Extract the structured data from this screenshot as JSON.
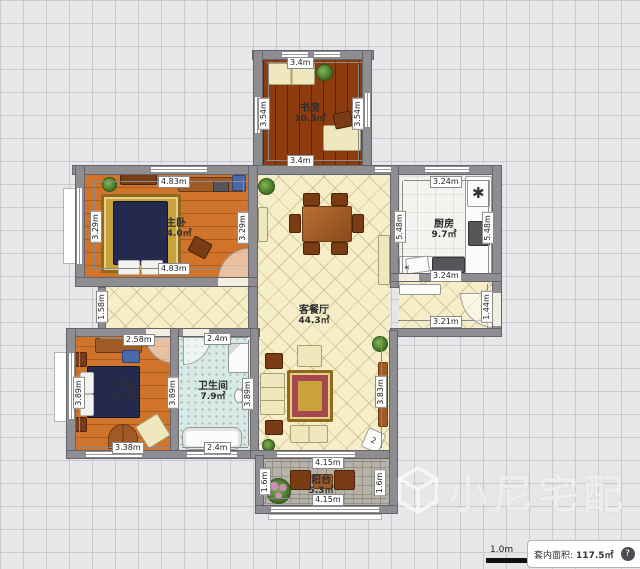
{
  "watermark": {
    "brand": "小尼宅配"
  },
  "status_bar": {
    "scale": "1.0m",
    "area_label": "套内面积:",
    "area_value": "117.5㎡",
    "help": "?"
  },
  "icons": {
    "sink": "✱",
    "double_arrow": "«",
    "box_tag": "2"
  },
  "rooms": {
    "study": {
      "name": "书房",
      "area": "10.5㎡"
    },
    "master": {
      "name": "主卧",
      "area": "14.0㎡"
    },
    "kitchen": {
      "name": "厨房",
      "area": "9.7㎡"
    },
    "living": {
      "name": "客餐厅",
      "area": "44.3㎡"
    },
    "second": {
      "name": "次卧",
      "area": "11.6㎡"
    },
    "bath": {
      "name": "卫生间",
      "area": "7.9㎡"
    },
    "balcony": {
      "name": "阳台",
      "area": "5.3㎡"
    }
  },
  "dims": {
    "study_top": "3.4m",
    "study_bottom": "3.4m",
    "study_left": "3.54m",
    "study_right": "3.54m",
    "master_top": "4.83m",
    "master_bottom": "4.83m",
    "master_left": "3.29m",
    "master_right": "3.29m",
    "kitchen_top": "3.24m",
    "kitchen_bottom": "3.24m",
    "kitchen_left": "5.48m",
    "kitchen_right": "5.48m",
    "second_top": "2.58m",
    "second_bottom": "3.38m",
    "second_left": "3.89m",
    "second_right": "3.89m",
    "bath_top": "2.4m",
    "bath_bottom": "2.4m",
    "bath_right": "3.89m",
    "hall_left": "1.58m",
    "entry_width": "3.21m",
    "entry_right": "1.44m",
    "living_right": "3.83m",
    "balcony_top": "4.15m",
    "balcony_bottom": "4.15m",
    "balcony_left": "1.6m",
    "balcony_right": "1.6m"
  },
  "colors": {
    "wall": "#8e8e92",
    "accent_wood": "#d0742c",
    "living_floor": "#f5eec9",
    "study_floor": "#8d3c10"
  }
}
